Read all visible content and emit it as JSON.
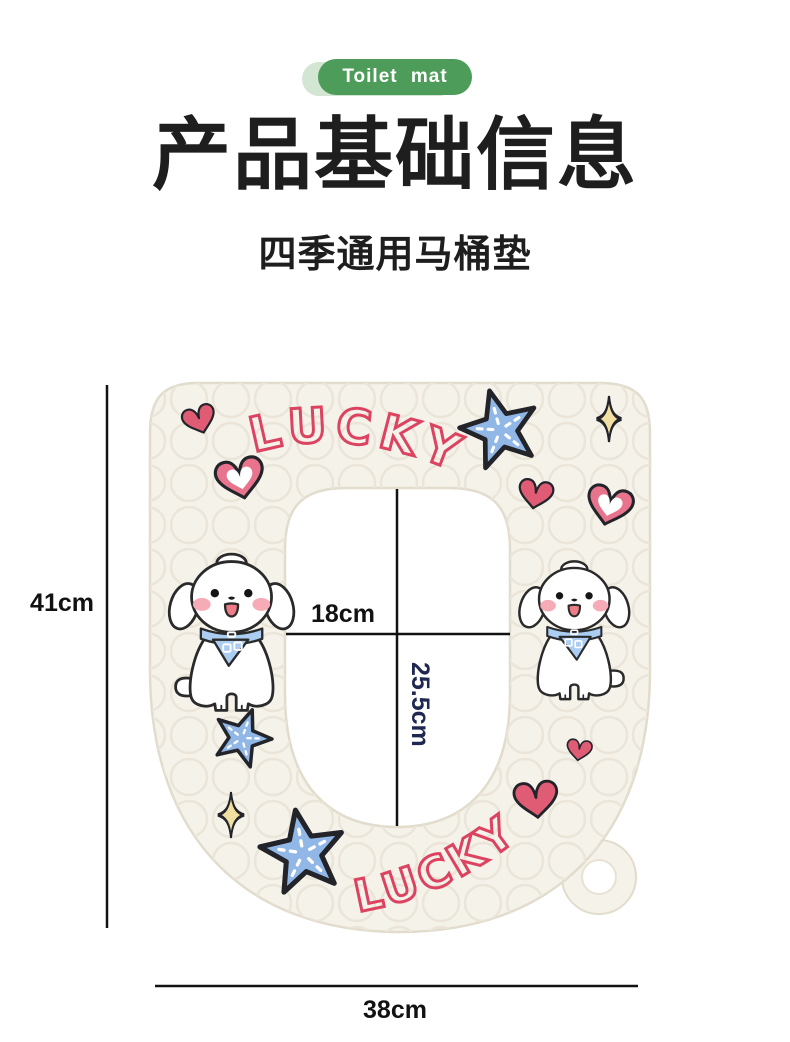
{
  "badge": {
    "label": "Toilet mat"
  },
  "header": {
    "title": "产品基础信息",
    "subtitle": "四季通用马桶垫"
  },
  "mat": {
    "brand_top": "LUCKY",
    "brand_bottom": "LUCKY"
  },
  "dimensions": {
    "overall_height": "41cm",
    "overall_width": "38cm",
    "opening_width": "18cm",
    "opening_depth": "25.5cm"
  },
  "colors": {
    "badge_green": "#4d9c5a",
    "badge_green_light": "#d3e5d3",
    "title_text": "#1e1e1e",
    "mat_cream": "#f5f2ea",
    "lucky_red": "#dc4360",
    "heart_pink": "#e05c75",
    "starfish_blue": "#90b7e6",
    "sparkle_yellow": "#f2e0a2",
    "bandana_blue": "#abcdf1",
    "depth_label_navy": "#1f2850",
    "dimension_black": "#121212"
  }
}
